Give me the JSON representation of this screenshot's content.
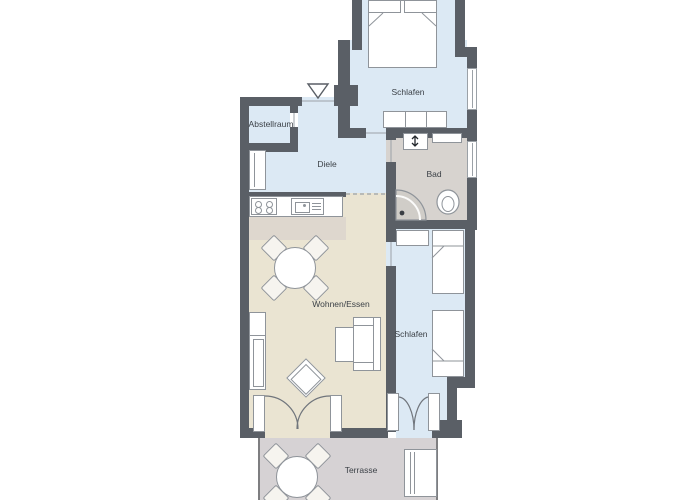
{
  "plan": {
    "labels": {
      "bedroom_top": "Schlafen",
      "storage": "Abstellraum",
      "hallway": "Diele",
      "bathroom": "Bad",
      "living_dining": "Wohnen/Essen",
      "bedroom_right": "Schlafen",
      "terrace": "Terrasse"
    },
    "colors": {
      "wall": "#5a5f66",
      "room-blue": "#dce9f4",
      "bath-floor": "#d7d3cf",
      "living-floor": "#eae4d2",
      "kitchen-strip": "#ded7ce",
      "terrace-floor": "#d6d2d4",
      "furniture-line": "#8f949a",
      "text": "#3c4147"
    }
  }
}
